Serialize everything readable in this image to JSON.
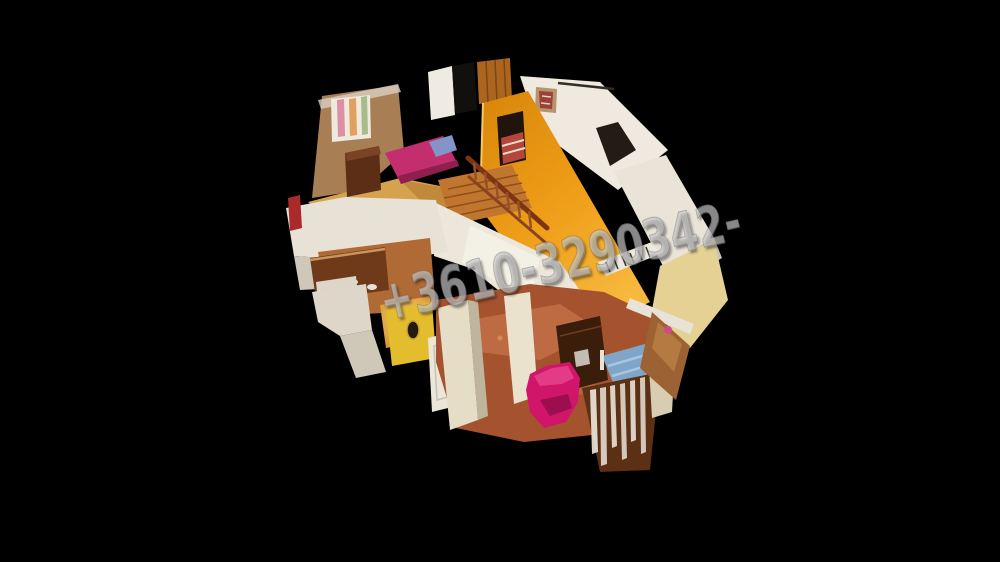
{
  "viewer": {
    "background_color": "#000000",
    "scene_label": "3D dollhouse cutaway view of a two-story house"
  },
  "watermark": {
    "text": "+3610-3290342-",
    "color": "#c3c3c3",
    "rotation_deg": -13
  },
  "palette": {
    "orange_stair_wall": "#e8940f",
    "white_wall": "#ece6db",
    "tan_bedroom_wall": "#a87f55",
    "wood_floor": "#d5a24e",
    "terracotta_floor": "#a5532e",
    "pink_bed": "#c22e6e",
    "magenta_armchair": "#d0156a",
    "blue_bed": "#7fa6c9",
    "yellow_room_wall": "#e3bd2e",
    "pale_yellow_wall": "#e4d193",
    "kitchen_cabinet": "#6e3a1a",
    "wood_banister": "#7d3413",
    "dark_stove": "#3a1d0b",
    "curtain_white": "#f2ede4"
  }
}
